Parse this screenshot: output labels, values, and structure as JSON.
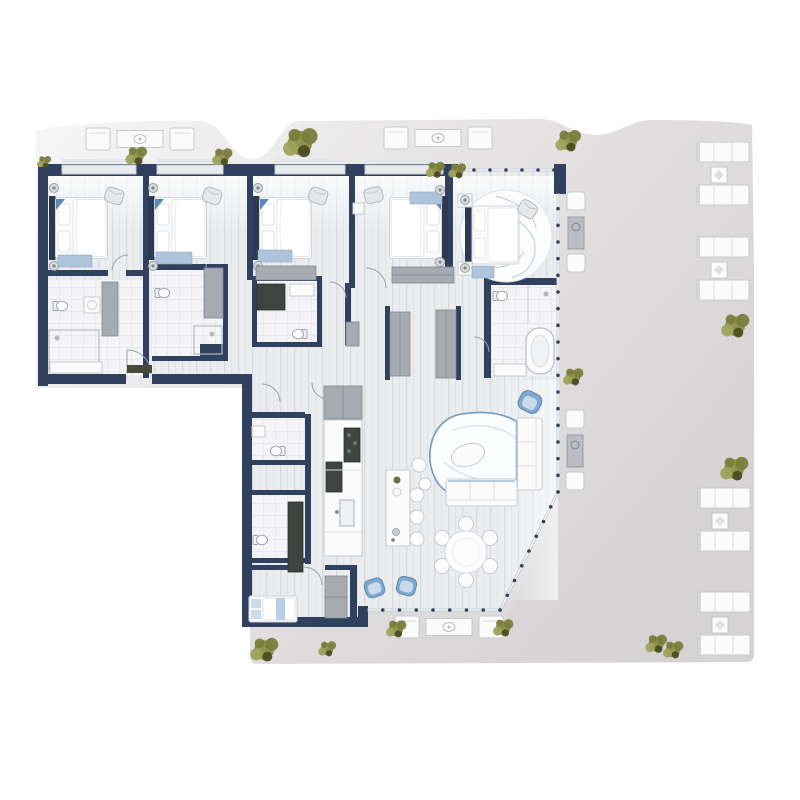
{
  "scene": {
    "type": "residential-floor-plan-render",
    "view": "top-down",
    "description": "Large apartment floor plan with four bedrooms in a top row, a master suite with round rug, service rooms and galley kitchen in a lower-left wing, open living-dining area with angled glass facade, and a wrap-around outdoor terrace with lounge furniture and plants",
    "visible_text": []
  },
  "palette": {
    "navy": "#30405f",
    "navyDark": "#273650",
    "floor": "#e9ebee",
    "floorLine": "#d9dce1",
    "tile": "#f4f4f6",
    "tileLine": "#e0e1e4",
    "terraceFrom": "#f7f6f6",
    "terraceTo": "#d5d3d3",
    "white": "#fbfbfc",
    "furnEdge": "#c7cacd",
    "wardrobe": "#a6abb2",
    "wardrobeEdge": "#81868f",
    "accentBlue": "#7fa8cd",
    "accentBlueLight": "#c9daea",
    "blueTrim": "#9cbcd8",
    "plant1": "#8d9049",
    "plant2": "#7a7d3c",
    "plant3": "#9fa35c",
    "plantDark": "#4a4d22",
    "glass": "#c9ced4"
  },
  "rooms": [
    "bedroom-1",
    "bedroom-2",
    "bedroom-3",
    "bedroom-4",
    "master-bedroom",
    "bedroom-5",
    "ensuite-bathroom-1",
    "ensuite-bathroom-2",
    "ensuite-bathroom-3",
    "master-bathroom",
    "wc-1",
    "wc-2",
    "kitchen",
    "living-room",
    "dining-area",
    "entry-hall",
    "corridor",
    "terrace"
  ],
  "furniture_inventory": {
    "double_beds": 5,
    "single_beds": 1,
    "toilets": 6,
    "bathtubs": 1,
    "sofas_indoor": 2,
    "armchairs_blue": 3,
    "dining_table_seats": 6,
    "kitchen_island_stools": 3,
    "outdoor_bench_pairs": 4,
    "outdoor_lounge_sets": 3,
    "outdoor_side_sets": 2
  },
  "glazing_segments": [
    {
      "x1": 458,
      "y1": 170,
      "x2": 554,
      "y2": 170
    },
    {
      "x1": 558,
      "y1": 192,
      "x2": 558,
      "y2": 492
    },
    {
      "x1": 558,
      "y1": 492,
      "x2": 500,
      "y2": 610
    },
    {
      "x1": 500,
      "y1": 610,
      "x2": 366,
      "y2": 610
    }
  ],
  "plants": [
    {
      "x": 44,
      "y": 162,
      "s": 0.55
    },
    {
      "x": 136,
      "y": 156,
      "s": 0.85
    },
    {
      "x": 222,
      "y": 157,
      "s": 0.8
    },
    {
      "x": 300,
      "y": 143,
      "s": 1.35
    },
    {
      "x": 435,
      "y": 170,
      "s": 0.75
    },
    {
      "x": 457,
      "y": 171,
      "s": 0.7
    },
    {
      "x": 568,
      "y": 141,
      "s": 1.0
    },
    {
      "x": 735,
      "y": 326,
      "s": 1.1
    },
    {
      "x": 573,
      "y": 377,
      "s": 0.8
    },
    {
      "x": 734,
      "y": 469,
      "s": 1.1
    },
    {
      "x": 656,
      "y": 644,
      "s": 0.85
    },
    {
      "x": 673,
      "y": 650,
      "s": 0.8
    },
    {
      "x": 264,
      "y": 650,
      "s": 1.1
    },
    {
      "x": 327,
      "y": 649,
      "s": 0.7
    },
    {
      "x": 396,
      "y": 629,
      "s": 0.8
    },
    {
      "x": 503,
      "y": 628,
      "s": 0.8
    }
  ],
  "terrace_furniture": {
    "bench_pairs": [
      {
        "x": 723,
        "y": 142
      },
      {
        "x": 723,
        "y": 237
      },
      {
        "x": 724,
        "y": 488
      },
      {
        "x": 724,
        "y": 592
      }
    ],
    "lounge_sets": [
      {
        "cx": 140,
        "cy": 139
      },
      {
        "cx": 438,
        "cy": 138
      },
      {
        "cx": 449,
        "cy": 627
      }
    ],
    "side_sets": [
      {
        "cx": 576,
        "cy": 192
      },
      {
        "cx": 575,
        "cy": 410
      }
    ]
  }
}
